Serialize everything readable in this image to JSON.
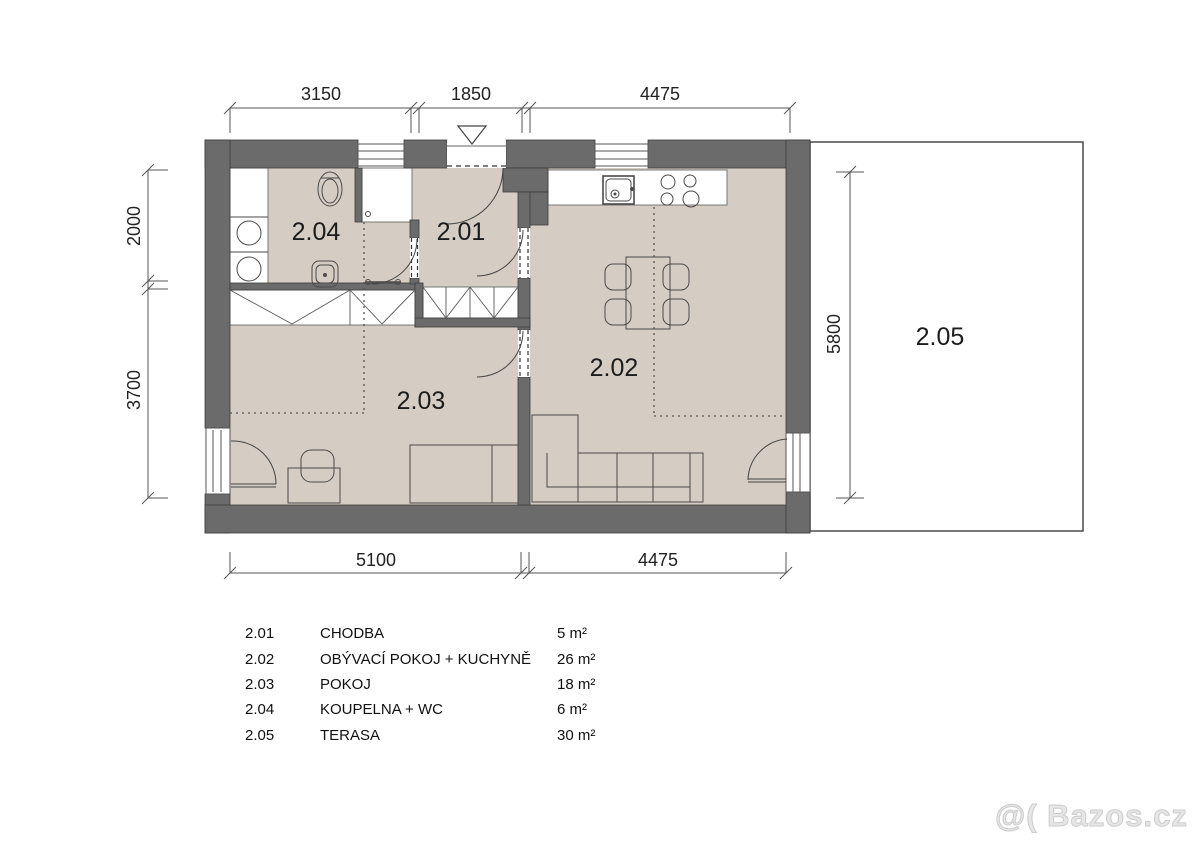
{
  "rooms": [
    {
      "number": "2.01",
      "name": "CHODBA",
      "area": "5 m²"
    },
    {
      "number": "2.02",
      "name": "OBÝVACÍ POKOJ + KUCHYNĚ",
      "area": "26 m²"
    },
    {
      "number": "2.03",
      "name": "POKOJ",
      "area": "18 m²"
    },
    {
      "number": "2.04",
      "name": "KOUPELNA + WC",
      "area": "6 m²"
    },
    {
      "number": "2.05",
      "name": "TERASA",
      "area": "30 m²"
    }
  ],
  "plan_labels": {
    "hallway": "2.01",
    "living_kitchen": "2.02",
    "room": "2.03",
    "bathroom": "2.04",
    "terrace": "2.05"
  },
  "dimensions": {
    "top": [
      "3150",
      "1850",
      "4475"
    ],
    "bottom": [
      "5100",
      "4475"
    ],
    "left": [
      "2000",
      "3700"
    ],
    "right": [
      "5800"
    ]
  },
  "watermark": "@( Bazos.cz",
  "colors": {
    "wall": "#6b6b6b",
    "floor": "#d5ccc3",
    "line": "#444444"
  }
}
